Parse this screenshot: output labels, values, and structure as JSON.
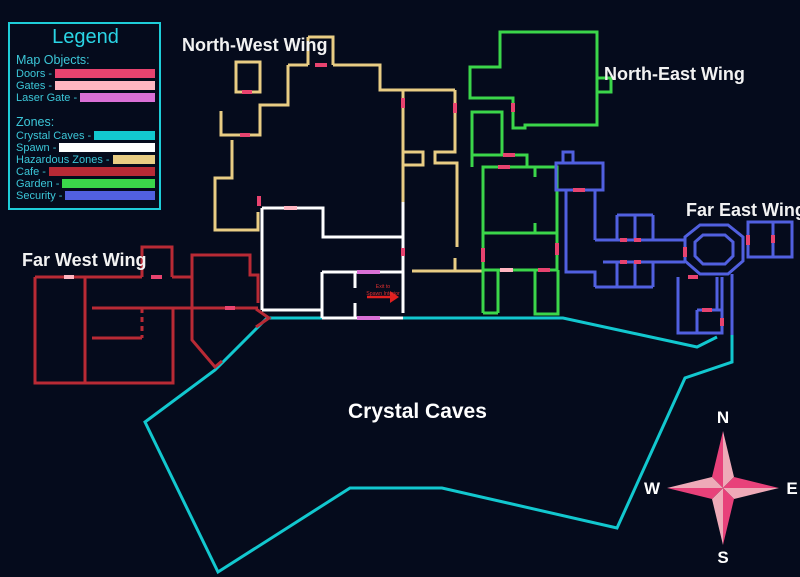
{
  "legend": {
    "title": "Legend",
    "sections": [
      {
        "header": "Map Objects:",
        "items": [
          {
            "label": "Doors -",
            "color": "#e8436f"
          },
          {
            "label": "Gates -",
            "color": "#ffb6c1"
          },
          {
            "label": "Laser Gate -",
            "color": "#da70d6"
          }
        ]
      },
      {
        "header": "Zones:",
        "items": [
          {
            "label": "Crystal Caves -",
            "color": "#12c8cf"
          },
          {
            "label": "Spawn -",
            "color": "#ffffff"
          },
          {
            "label": "Hazardous Zones -",
            "color": "#e9cd84"
          },
          {
            "label": "Cafe -",
            "color": "#b92a35"
          },
          {
            "label": "Garden -",
            "color": "#3bd64a"
          },
          {
            "label": "Security -",
            "color": "#5160e0"
          }
        ]
      }
    ]
  },
  "labels": {
    "north_west": "North-West Wing",
    "north_east": "North-East Wing",
    "far_east": "Far East Wing",
    "far_west": "Far West Wing",
    "crystal_caves": "Crystal Caves"
  },
  "spawn_note": {
    "line1": "Exit to",
    "line2": "Spawn Interior",
    "color": "#e03030",
    "arrow_color": "#e02020"
  },
  "compass": {
    "n": "N",
    "s": "S",
    "w": "W",
    "e": "E",
    "dark": "#e8417a",
    "light": "#eeaab8",
    "triangles": [
      {
        "points": "723,431 712,477 723,488",
        "shade": "dark"
      },
      {
        "points": "723,431 734,477 723,488",
        "shade": "light"
      },
      {
        "points": "779,488 734,477 723,488",
        "shade": "dark"
      },
      {
        "points": "779,488 734,499 723,488",
        "shade": "light"
      },
      {
        "points": "723,545 734,499 723,488",
        "shade": "dark"
      },
      {
        "points": "723,545 712,499 723,488",
        "shade": "light"
      },
      {
        "points": "667,488 712,499 723,488",
        "shade": "dark"
      },
      {
        "points": "667,488 712,477 723,488",
        "shade": "light"
      }
    ]
  },
  "map": {
    "wall_width": 3,
    "zones": [
      {
        "name": "crystal-caves-walls",
        "color": "#12c8cf",
        "paths": [
          "M267,318 H563 L697,347 L717,337",
          "M732,335 V362 L685,378 L617,528 L442,488 H350 L218,572 L145,422 L215,370 L267,318"
        ]
      },
      {
        "name": "hazardous-walls",
        "color": "#e9cd84",
        "paths": [
          "M308,37 H333 V65",
          "M308,37 V65",
          "M288,65 H308",
          "M333,65 H380 V90 H455",
          "M403,90 V202",
          "M403,152 H423 V165 H403",
          "M455,90 V152 H435 V163 H457 V247",
          "M455,258 V271",
          "M412,271 H483",
          "M288,65 V105 H260 V135 H221 V111",
          "M236,62 H260 V92 H236 Z",
          "M232,140 V178 H215 V230 H258 V212"
        ]
      },
      {
        "name": "garden-walls",
        "color": "#3bd64a",
        "paths": [
          "M500,32 H597 V125 H525 V128 H513 V98 H470 V67 H500 Z",
          "M597,78 H611 V92 H597",
          "M472,112 H502 V155 H472 Z",
          "M502,155 H527 V167",
          "M472,155 V167",
          "M483,167 H557 V233 H483 Z",
          "M535,167 V177",
          "M535,223 V233",
          "M483,233 V313",
          "M483,313 H498",
          "M498,270 V313",
          "M557,233 V270",
          "M483,270 H557",
          "M535,270 V314 H558 V270"
        ]
      },
      {
        "name": "security-walls",
        "color": "#5160e0",
        "paths": [
          "M563,163 V152 H573 V163",
          "M556,163 H603 V190 H556 Z",
          "M566,190 V237",
          "M595,190 V240",
          "M566,237 V272 H595 V287",
          "M595,240 H685",
          "M603,262 H685",
          "M617,215 H653",
          "M617,215 V240",
          "M653,215 V240",
          "M635,215 V240",
          "M617,262 V287",
          "M653,262 V287",
          "M617,287 H653",
          "M635,262 V287",
          "M595,287 H617",
          "M700,225 H728 L743,237 V261 L728,274 H700 L685,261 V237 Z",
          "M703,235 H725 L733,242 V256 L725,264 H703 L695,256 V242 Z",
          "M748,222 H792 V257 H748 Z",
          "M773,222 V257",
          "M678,277 V333 H722 V277",
          "M697,310 H722",
          "M697,310 V333",
          "M717,277 V310",
          "M732,274 V335"
        ]
      },
      {
        "name": "cafe-walls",
        "color": "#b92a35",
        "paths": [
          "M35,277 H142",
          "M142,277 V247 H172 V277",
          "M172,277 H192 V255 H250 V275 H258 V303",
          "M35,277 V383 H173 V308",
          "M85,277 V383",
          "M92,308 H258",
          "M92,338 H142",
          "M192,277 V340 L215,367 L222,361",
          "M256,309 L269,318 L256,327"
        ]
      },
      {
        "name": "cafe-dashed-walls",
        "color": "#b92a35",
        "dashed": true,
        "paths": [
          "M142,308 V338"
        ]
      },
      {
        "name": "spawn-walls",
        "color": "#ffffff",
        "paths": [
          "M262,208 H323 V237 H403",
          "M403,202 V313",
          "M262,208 V310",
          "M262,310 H322",
          "M322,272 H403",
          "M322,272 V318",
          "M322,318 H403",
          "M355,272 V288",
          "M355,303 V318"
        ]
      }
    ],
    "markers": {
      "doors": {
        "color": "#e8436f",
        "paths": [
          "M315,65 H327",
          "M403,98 V108",
          "M455,103 V113",
          "M240,135 H250",
          "M242,92 H252",
          "M259,196 V206",
          "M403,248 V256",
          "M513,103 V112",
          "M503,155 H515",
          "M498,167 H510",
          "M483,248 V262",
          "M557,243 V255",
          "M538,270 H550",
          "M573,190 H585",
          "M620,240 H627",
          "M634,240 H641",
          "M620,262 H627",
          "M634,262 H641",
          "M685,247 V257",
          "M748,235 V245",
          "M773,235 V243",
          "M702,310 H712",
          "M688,277 H698",
          "M722,318 V326",
          "M151,277 H162",
          "M225,308 H235"
        ]
      },
      "gates": {
        "color": "#ffb6c1",
        "paths": [
          "M284,208 H297",
          "M500,270 H513",
          "M64,277 H74"
        ]
      },
      "lasers": {
        "color": "#da70d6",
        "paths": [
          "M357,272 H380",
          "M357,318 H380"
        ]
      }
    },
    "spawn_arrow": {
      "line": "M367,297 H390",
      "head": "390,291 399,297 390,303"
    }
  }
}
